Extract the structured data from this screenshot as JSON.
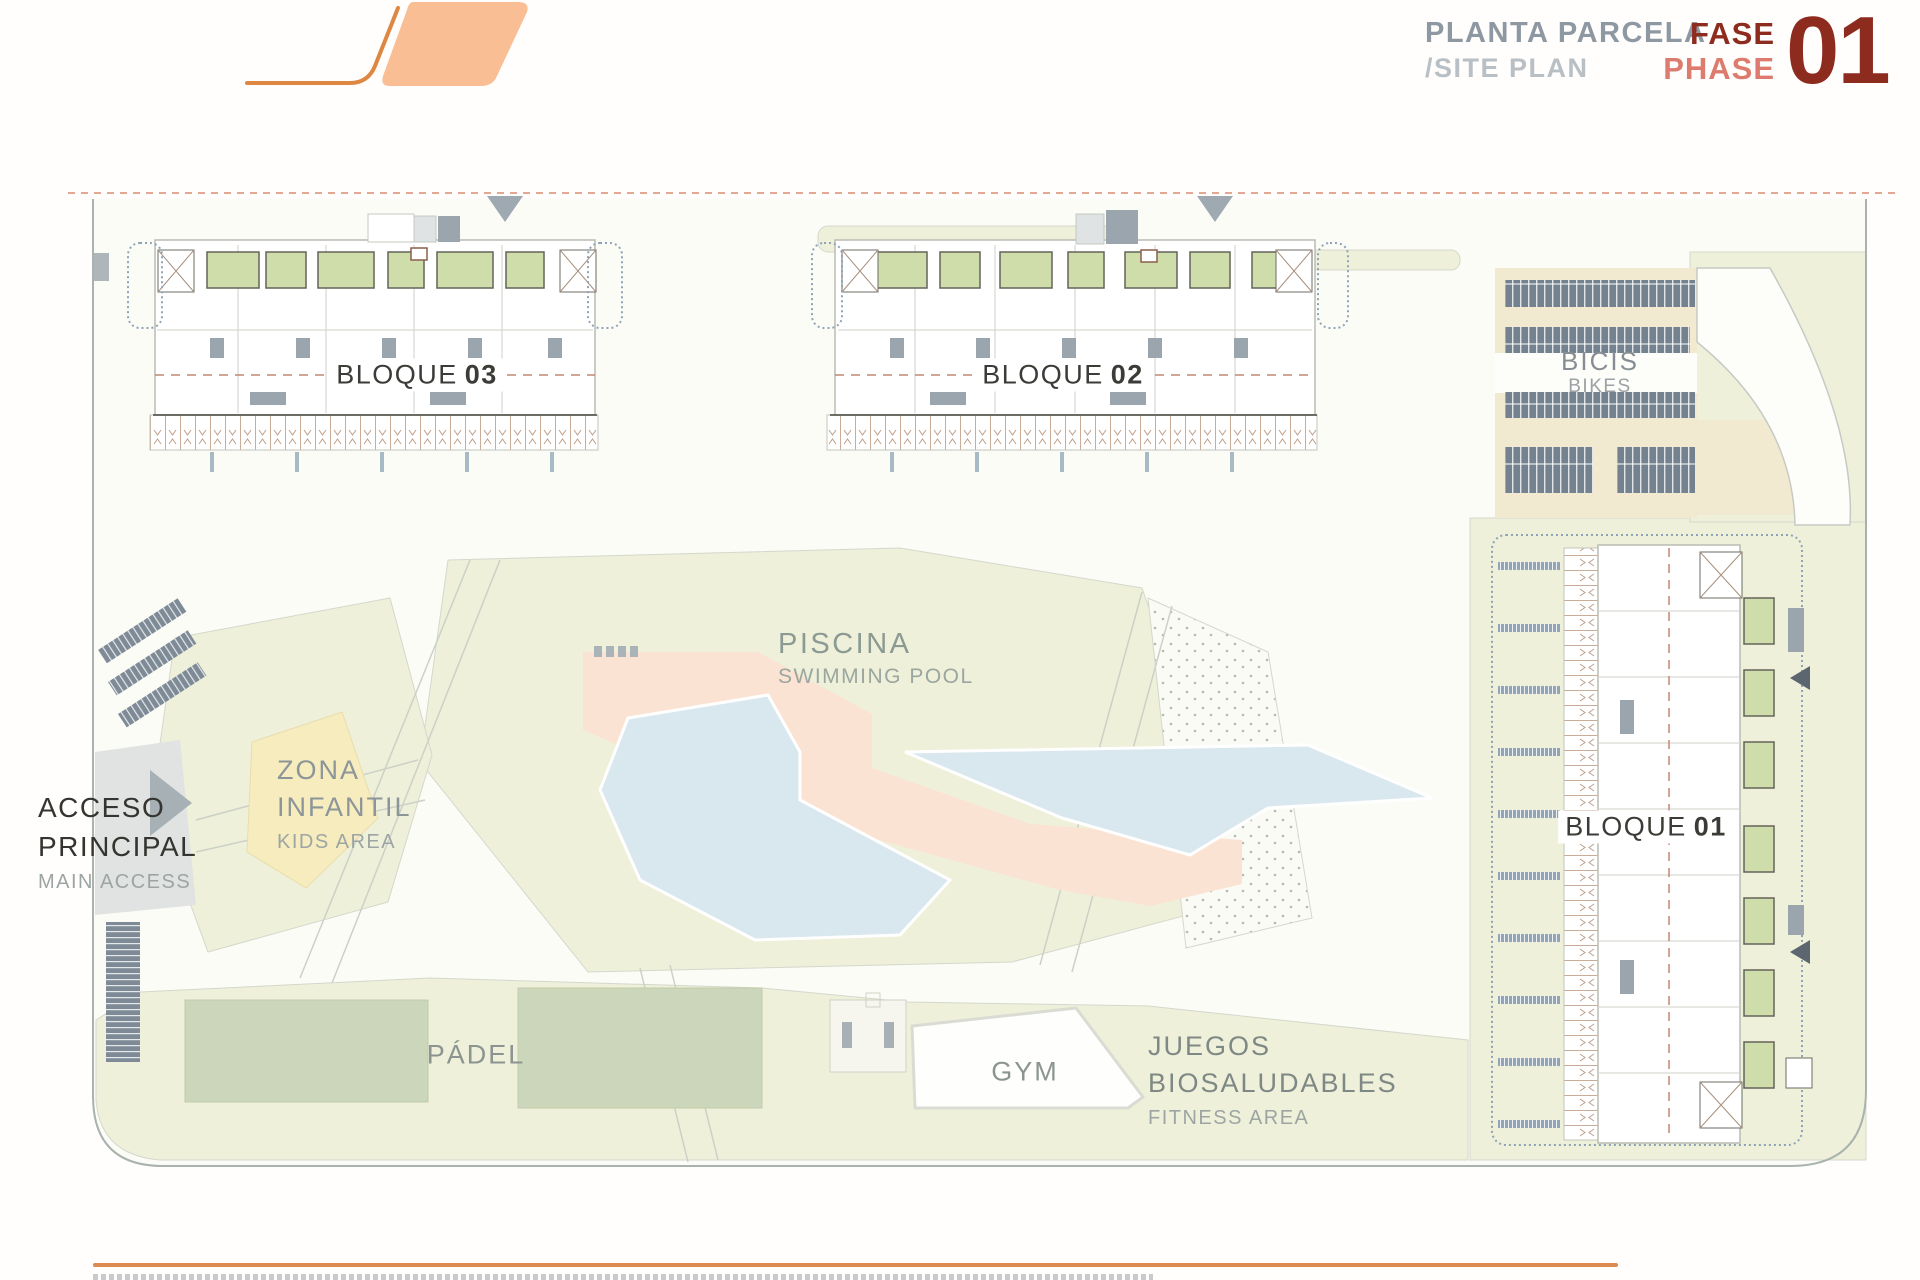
{
  "header": {
    "title": "PLANTA PARCELA",
    "subtitle": "/SITE PLAN",
    "phase_word_es": "FASE",
    "phase_word_en": "PHASE",
    "phase_number": "01"
  },
  "plan": {
    "bloque03": {
      "label": "BLOQUE",
      "number": "03"
    },
    "bloque02": {
      "label": "BLOQUE",
      "number": "02"
    },
    "bloque01": {
      "label": "BLOQUE",
      "number": "01"
    },
    "bikes": {
      "es": "BICIS",
      "en": "BIKES"
    },
    "pool": {
      "es": "PISCINA",
      "en": "SWIMMING POOL"
    },
    "kids": {
      "es_line1": "ZONA",
      "es_line2": "INFANTIL",
      "en": "KIDS AREA"
    },
    "access": {
      "es_line1": "ACCESO",
      "es_line2": "PRINCIPAL",
      "en": "MAIN ACCESS"
    },
    "padel": {
      "es": "PÁDEL"
    },
    "gym": {
      "es": "GYM"
    },
    "fitness": {
      "es_line1": "JUEGOS",
      "es_line2": "BIOSALUDABLES",
      "en": "FITNESS AREA"
    }
  },
  "colors": {
    "accent_orange": "#dd8a52",
    "logo_fill": "#f9be93",
    "logo_stroke": "#dd8743",
    "title_gray": "#8d98a2",
    "subtitle_gray": "#b8bfc5",
    "phase_dark_red": "#8e2b1f",
    "phase_salmon": "#dd7c6e",
    "lawn_green": "#eef0d9",
    "court_green": "#cbd6ba",
    "terrace_green": "#cfddab",
    "pool_water": "#d9e8ee",
    "pool_deck": "#fae3d2",
    "bike_rack_slate": "#74828f",
    "bikes_beige": "#f1ead0",
    "kids_yellow": "#f6ecbe",
    "boundary_gray": "#a9b2ae",
    "dashed_line_salmon": "#d98b72"
  }
}
